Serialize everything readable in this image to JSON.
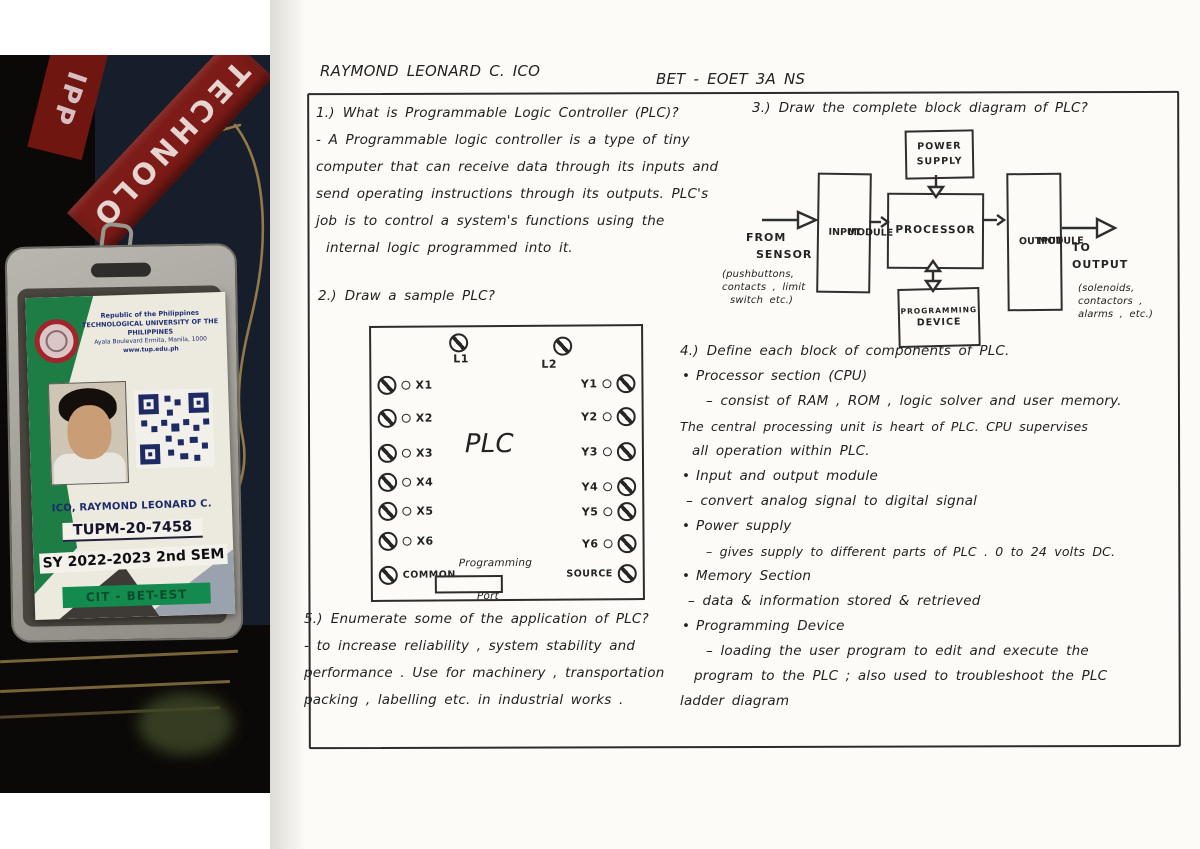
{
  "colors": {
    "lanyard_red": "#7c1b17",
    "card_green": "#1e7c45",
    "banner_green": "#138a4e",
    "logo_red": "#a3242b",
    "qr_navy": "#1d2a63",
    "id_text_navy": "#1c2a6b"
  },
  "badge": {
    "lanyard_text": "TECHNOLO",
    "lanyard_text_2": "IPP",
    "header_line1": "Republic of the Philippines",
    "header_line2": "TECHNOLOGICAL UNIVERSITY OF THE PHILIPPINES",
    "header_line3": "Ayala Boulevard Ermita, Manila, 1000",
    "header_line4": "www.tup.edu.ph",
    "name": "ICO, RAYMOND LEONARD C.",
    "student_no": "TUPM-20-7458",
    "term": "SY 2022-2023 2nd SEM",
    "college": "CIT - BET-EST"
  },
  "doc": {
    "student_name": "RAYMOND LEONARD C. ICO",
    "course_section": "BET - EOET 3A NS",
    "q1": {
      "label": "1.)",
      "question": "What is Programmable Logic Controller (PLC)?",
      "answer": [
        "- A Programmable logic controller is a type of tiny",
        "computer that can receive data through its inputs and",
        "send operating instructions through its outputs. PLC's",
        "job is to control a system's functions using the",
        "internal logic programmed into it."
      ]
    },
    "q2": {
      "label": "2.)",
      "question": "Draw a sample PLC?"
    },
    "plc": {
      "title": "PLC",
      "l1": "L1",
      "l2": "L2",
      "left": [
        "X1",
        "X2",
        "X3",
        "X4",
        "X5",
        "X6"
      ],
      "left_last": "COMMON",
      "right": [
        "Y1",
        "Y2",
        "Y3",
        "Y4",
        "Y5",
        "Y6"
      ],
      "right_last": "SOURCE",
      "port_top": "Programming",
      "port_bottom": "Port"
    },
    "q5": {
      "label": "5.)",
      "question": "Enumerate some of the application of PLC?",
      "answer": [
        "- to increase reliability , system stability and",
        "performance . Use for machinery , transportation",
        "packing , labelling etc. in industrial works ."
      ]
    },
    "q3": {
      "label": "3.)",
      "question": "Draw the complete block diagram of PLC?"
    },
    "block": {
      "power_l1": "POWER",
      "power_l2": "SUPPLY",
      "input_w1": "INPUT",
      "input_w2": "MODULE",
      "processor": "PROCESSOR",
      "output_w1": "OUTPUT",
      "output_w2": "MODULE",
      "device_l1": "PROGRAMMING",
      "device_l2": "DEVICE",
      "from_l1": "FROM",
      "from_l2": "SENSOR",
      "from_sub": [
        "(pushbuttons,",
        "contacts , limit",
        "switch etc.)"
      ],
      "to_l1": "TO",
      "to_l2": "OUTPUT",
      "to_sub": [
        "(solenoids,",
        "contactors ,",
        "alarms , etc.)"
      ]
    },
    "q4": {
      "label": "4.)",
      "question": "Define each block of components of PLC.",
      "items": [
        {
          "title": "Processor section (CPU)",
          "lines": [
            "– consist of RAM , ROM , logic solver and user memory.",
            "The central processing unit is heart of PLC. CPU supervises",
            "all operation within PLC."
          ]
        },
        {
          "title": "Input and output module",
          "lines": [
            "– convert analog signal to digital signal"
          ]
        },
        {
          "title": "Power supply",
          "lines": [
            "– gives supply to different parts of PLC . 0 to 24 volts DC."
          ]
        },
        {
          "title": "Memory Section",
          "lines": [
            "– data & information stored & retrieved"
          ]
        },
        {
          "title": "Programming Device",
          "lines": [
            "– loading the user program to edit and execute the",
            "program to the PLC ; also used to troubleshoot the PLC",
            "ladder diagram"
          ]
        }
      ]
    }
  }
}
